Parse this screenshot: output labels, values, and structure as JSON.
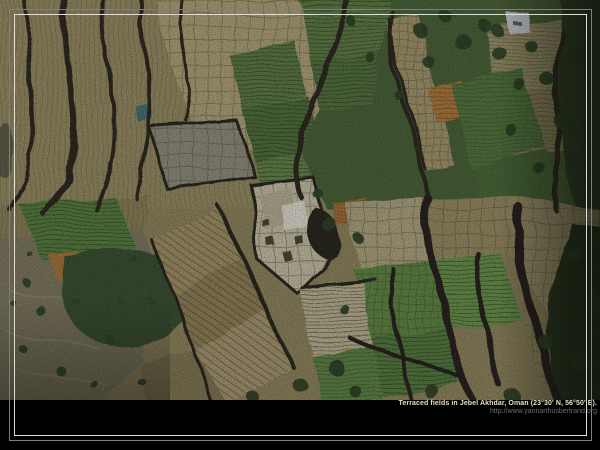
{
  "wallpaper": {
    "background_color": "#000000",
    "frame": {
      "outer_color": "#7f7f7f",
      "inner_color": "#dededa"
    }
  },
  "photo": {
    "description": "Aerial photograph of terraced fields: a mosaic of khaki, tan and green cultivated plots divided by dark sinuous terrace walls, rocky scrubland with bushes at lower left, dense dark-green trees at upper right, a pale checkered plot at the center and a small white structure among trees at the top",
    "palette": {
      "khaki_field": "#968a5b",
      "tan_checkered": "#b3a476",
      "pale_plot": "#cdc6a9",
      "white_plot": "#ebe8da",
      "green_field": "#547838",
      "bright_green": "#5d8140",
      "dark_green_trees": "#1d3314",
      "forest_patch": "#2a4520",
      "rocky_scrub": "#7a7359",
      "orange_plot": "#b2752e",
      "terrace_wall": "#17140b",
      "water_tank": "#3a6b70"
    }
  },
  "caption": {
    "title": "Terraced fields in Jebel Akhdar, Oman (23°30' N, 56°50' E).",
    "url": "http://www.yannarthusbertrand.org",
    "title_color": "#e9e0bd",
    "url_color": "#6e6e6e"
  }
}
